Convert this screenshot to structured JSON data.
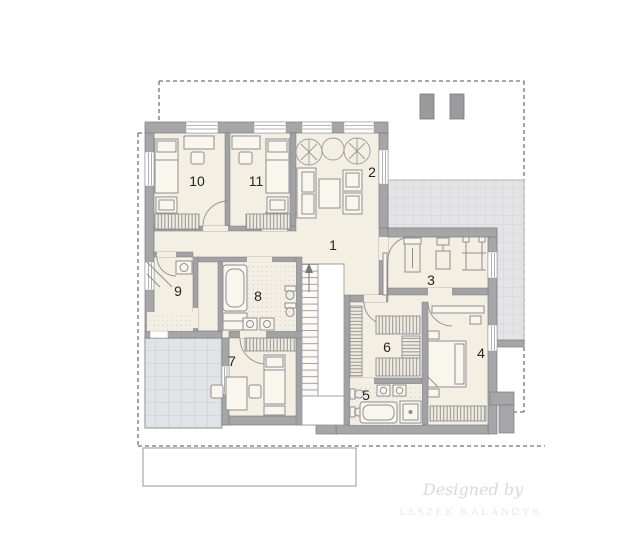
{
  "plan": {
    "type": "floor-plan",
    "rooms": [
      {
        "id": "hall",
        "number": "1"
      },
      {
        "id": "lounge",
        "number": "2"
      },
      {
        "id": "gym",
        "number": "3"
      },
      {
        "id": "master-bedroom",
        "number": "4"
      },
      {
        "id": "bathroom-main",
        "number": "5"
      },
      {
        "id": "walk-in-closet",
        "number": "6"
      },
      {
        "id": "bedroom-7",
        "number": "7"
      },
      {
        "id": "bathroom-8",
        "number": "8"
      },
      {
        "id": "storage-9",
        "number": "9"
      },
      {
        "id": "bedroom-10",
        "number": "10"
      },
      {
        "id": "bedroom-11",
        "number": "11"
      }
    ],
    "watermark": {
      "line1": "Designed by",
      "line2": "LESZEK KALANDYK"
    },
    "colors": {
      "wall": "#a6a6a9",
      "floor": "#f4efe3",
      "terrace": "#e4e4e7",
      "balcony": "#e2e3e6",
      "roof_outline_dash": "#737376",
      "room_label": "#242424",
      "watermark_script": "#d9d9de",
      "watermark_caps": "#e7e7ec"
    }
  }
}
